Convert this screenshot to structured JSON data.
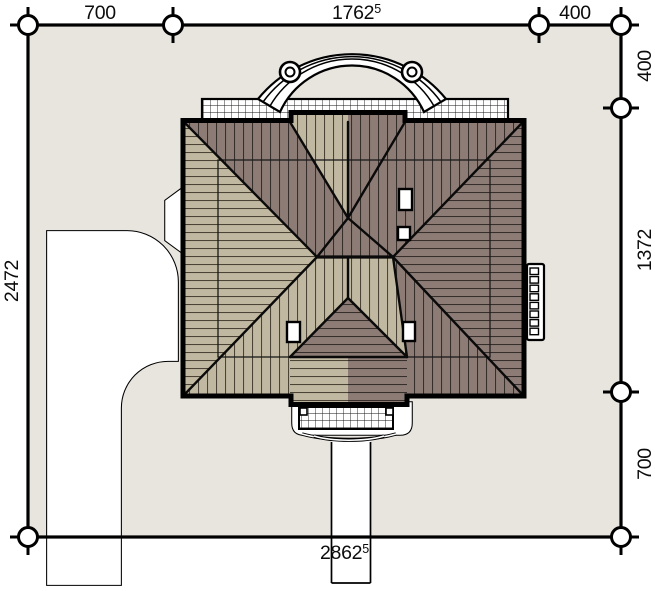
{
  "page": {
    "type": "architectural-site-plan"
  },
  "dimensions": {
    "top": {
      "seg1": "700",
      "seg2": "1762",
      "seg2_sup": "5",
      "seg3": "400"
    },
    "right": {
      "seg1": "400",
      "seg2": "1372",
      "seg3": "700"
    },
    "left": {
      "total": "2472"
    },
    "bottom": {
      "total": "2862",
      "total_sup": "5"
    }
  },
  "colors": {
    "paper": "#ffffff",
    "lot_fill": "#e8e4de",
    "roof_tan": "#c1b8a2",
    "roof_brown": "#8d7c76",
    "line": "#000000"
  }
}
